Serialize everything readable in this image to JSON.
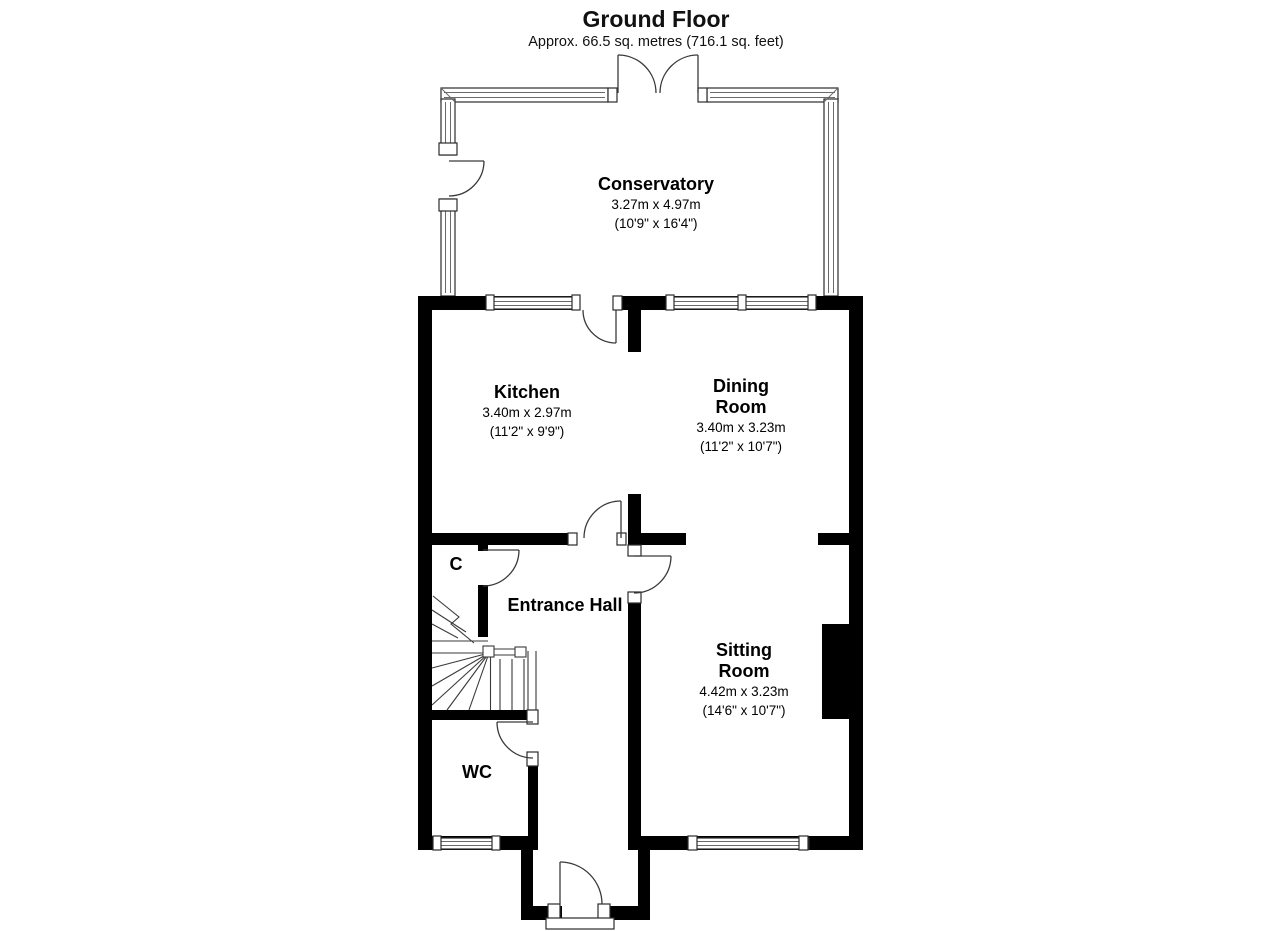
{
  "header": {
    "title": "Ground Floor",
    "subtitle": "Approx. 66.5 sq. metres (716.1 sq. feet)"
  },
  "rooms": {
    "conservatory": {
      "name": "Conservatory",
      "metric": "3.27m x 4.97m",
      "imperial": "(10'9\" x 16'4\")"
    },
    "kitchen": {
      "name": "Kitchen",
      "metric": "3.40m x 2.97m",
      "imperial": "(11'2\" x 9'9\")"
    },
    "dining": {
      "name": "Dining Room",
      "metric": "3.40m x 3.23m",
      "imperial": "(11'2\" x 10'7\")"
    },
    "hall": {
      "name": "Entrance Hall"
    },
    "sitting": {
      "name": "Sitting Room",
      "metric": "4.42m x 3.23m",
      "imperial": "(14'6\" x 10'7\")"
    },
    "cupboard": {
      "name": "C"
    },
    "wc": {
      "name": "WC"
    }
  },
  "colors": {
    "wall": "#000000",
    "line": "#3a3a3a",
    "background": "#ffffff"
  }
}
